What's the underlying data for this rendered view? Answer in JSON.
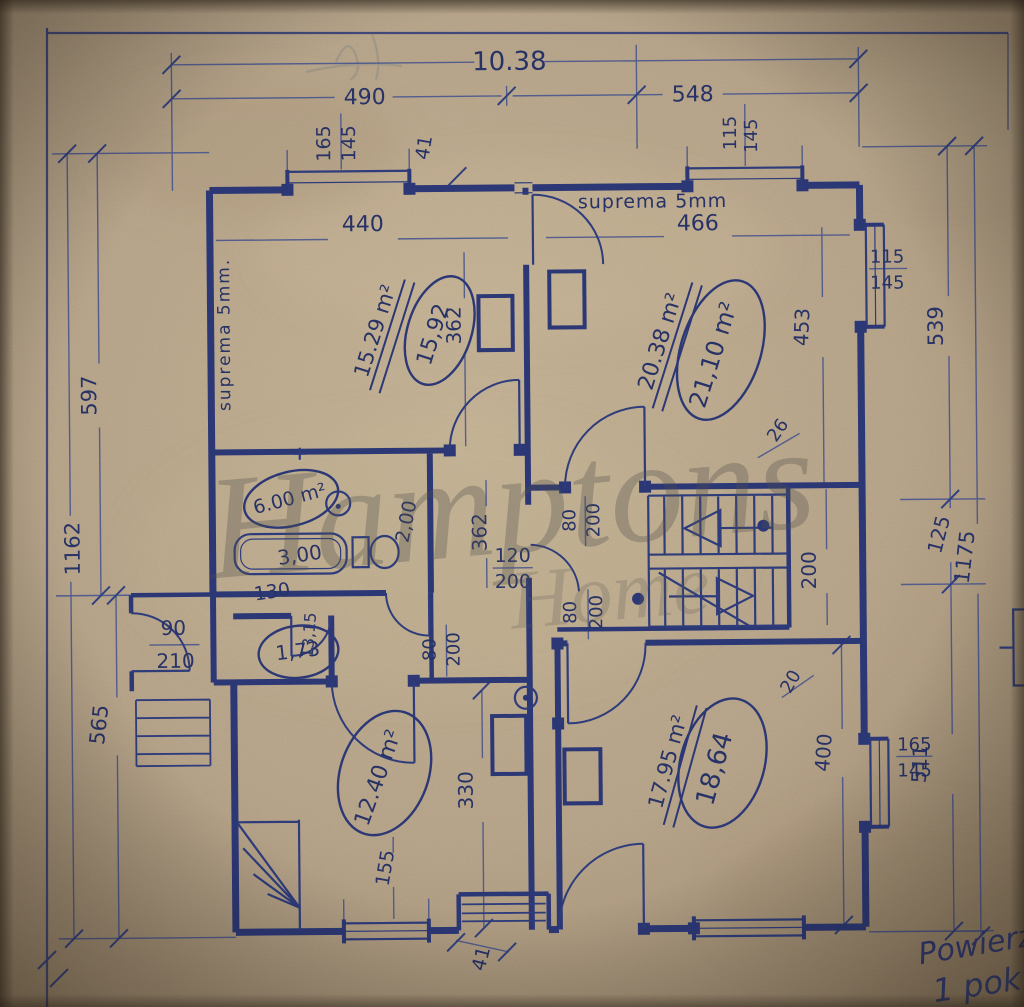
{
  "colors": {
    "ink": "#2c3876",
    "ink_light": "#41508e",
    "paper": "#b6a387",
    "watermark": "#50504c"
  },
  "materials": {
    "tl": "suprema 5mm.",
    "tr": "suprema 5mm"
  },
  "watermark": {
    "w1": "Hamptons",
    "w2": "Home"
  },
  "notes": {
    "n1": "Powierzch",
    "n2": "1 pok"
  },
  "rooms": {
    "tl_old": "15.29 m²",
    "tl_new": "15,92",
    "tr_old": "20.38 m²",
    "tr_new": "21,10 m²",
    "bath": "6.00 m²",
    "bath_tub": "3,00",
    "bath_door": "2,00",
    "wc": "1,73",
    "bl": "12.40 m²",
    "br_old": "17.95 m²",
    "br_new": "18,64"
  },
  "dims": {
    "overall": "10.38",
    "span_left": "490",
    "span_right": "548",
    "win_tl_w": "165",
    "win_tl_h": "145",
    "wall_a": "41",
    "win_tr_w": "115",
    "win_tr_h": "145",
    "room_tl_w": "440",
    "room_tr_w": "466",
    "room_tl_d": "362",
    "room_tr_d": "453",
    "left_outer": "1162",
    "left_upper": "597",
    "left_lower": "565",
    "door_entry_w": "90",
    "door_entry_h": "210",
    "right_outer": "1175",
    "right_upper": "539",
    "right_mid": "125",
    "right_lower": "511",
    "win_r1_w": "115",
    "win_r1_h": "145",
    "win_r2_w": "165",
    "win_r2_h": "145",
    "hall_d": "362",
    "door_main_w": "120",
    "door_main_h": "200",
    "door1_w": "80",
    "door1_h": "200",
    "door2_w": "80",
    "door2_h": "200",
    "door3_w": "80",
    "door3_h": "200",
    "stair": "200",
    "room_bl_d": "330",
    "room_br_h": "400",
    "win_b": "155",
    "wall_b": "41",
    "off_20": "20",
    "off_26": "26",
    "wc_w": "130",
    "wc_side": "13,15"
  }
}
